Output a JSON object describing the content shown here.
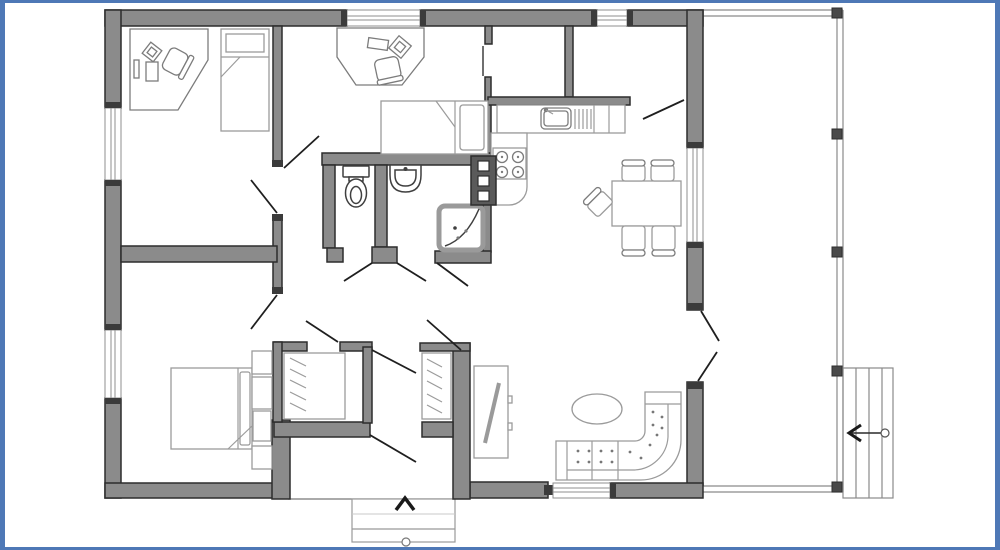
{
  "meta": {
    "type": "floor-plan",
    "description": "Single-storey house floor plan with two small bedrooms with desks, master bedroom, WC, bathroom with shower, walk-in closets, entrance hall with outside steps, open kitchen-dining-living area and a large side deck with stairs"
  },
  "colors": {
    "frame": "#4e78b6",
    "background": "#ffffff",
    "wall_fill": "#8b8b8b",
    "wall_stroke": "#2d2d2d",
    "door_swing": "#1f1f1f",
    "deck_line": "#8a8a8a",
    "cap_dark": "#3b3b3b",
    "appliance_dark": "#5a5a5a"
  },
  "rooms": [
    {
      "name": "bedroom-office-1",
      "position": "top-left",
      "furniture": [
        "corner desk",
        "office chair",
        "single bed"
      ]
    },
    {
      "name": "bedroom-2",
      "position": "top-middle",
      "furniture": [
        "desk",
        "office chair",
        "single bed"
      ]
    },
    {
      "name": "walk-in-closet",
      "position": "top-center",
      "furniture": []
    },
    {
      "name": "utility-room",
      "position": "top-right-of-center",
      "furniture": []
    },
    {
      "name": "wc",
      "position": "center",
      "furniture": [
        "toilet"
      ]
    },
    {
      "name": "bathroom",
      "position": "center",
      "furniture": [
        "washbasin",
        "corner shower"
      ]
    },
    {
      "name": "kitchen",
      "position": "center-right",
      "furniture": [
        "counter with sink",
        "stove 4 burners",
        "fridge column"
      ]
    },
    {
      "name": "dining-area",
      "position": "right",
      "furniture": [
        "dining table",
        "5 chairs"
      ]
    },
    {
      "name": "living-room",
      "position": "bottom-right",
      "furniture": [
        "corner sofa",
        "oval coffee table",
        "tv-cabinet"
      ]
    },
    {
      "name": "bedroom-3",
      "position": "bottom-left",
      "furniture": [
        "double bed",
        "shelf column"
      ]
    },
    {
      "name": "closet-a",
      "position": "bottom-center",
      "furniture": [
        "wardrobe with hangers"
      ]
    },
    {
      "name": "closet-b",
      "position": "bottom-center",
      "furniture": [
        "wardrobe with hangers"
      ]
    },
    {
      "name": "entrance-hall",
      "position": "bottom-center",
      "furniture": [
        "entry steps outside"
      ]
    },
    {
      "name": "deck",
      "position": "right-side",
      "furniture": [
        "posts",
        "exterior stairs"
      ]
    }
  ],
  "features": {
    "windows": 6,
    "exterior_doors": [
      "front entrance with step arrow",
      "double door to deck"
    ],
    "deck_posts": 5,
    "stair_arrow_direction": "left",
    "entrance_arrow_direction": "up"
  }
}
